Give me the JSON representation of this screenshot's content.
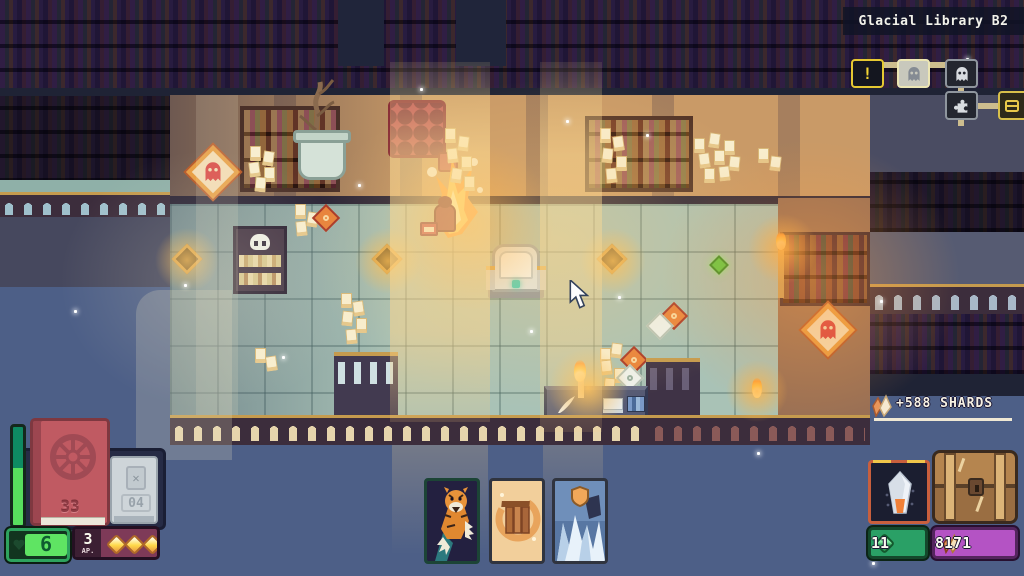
{
  "location": {
    "title": "Glacial Library B2"
  },
  "minimap": {
    "rooms": [
      {
        "id": "event-room",
        "icon": "exclamation-icon",
        "label": "!"
      },
      {
        "id": "ghost-room-current",
        "icon": "ghost-icon"
      },
      {
        "id": "ghost-room",
        "icon": "ghost-icon"
      },
      {
        "id": "puzzle-room",
        "icon": "puzzle-icon"
      },
      {
        "id": "treasure-room",
        "icon": "treasure-icon"
      }
    ]
  },
  "reward_banner": {
    "text": "+588 SHARDS",
    "icon": "shards-icon"
  },
  "player": {
    "deck_count": "33",
    "discard_count": "04",
    "discard_icon_glyph": "✕",
    "health": "6",
    "ap": {
      "value": "3",
      "label": "AP.",
      "pips": 3
    }
  },
  "hand": [
    {
      "name": "tiger-card",
      "selected": true
    },
    {
      "name": "gate-card",
      "selected": false
    },
    {
      "name": "ice-wall-card",
      "selected": false
    }
  ],
  "resources": {
    "gems": "11",
    "shards": "8171"
  },
  "colors": {
    "health_green": "#5fe463",
    "ap_maroon": "#7e3a58",
    "gem_badge_green": "#2aa066",
    "shard_badge_purple": "#b453c4",
    "accent_gold": "#f0c64a",
    "minimap_alert_yellow": "#f2d435"
  }
}
